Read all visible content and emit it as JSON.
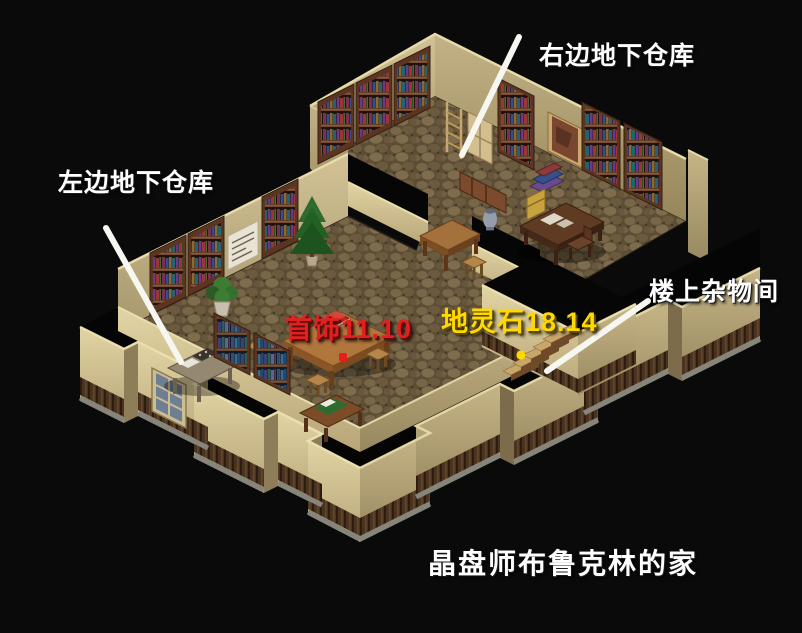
{
  "scene_title": "晶盘师布鲁克林的家",
  "annotations": {
    "right_basement": "右边地下仓库",
    "left_basement": "左边地下仓库",
    "upstairs_storage": "楼上杂物间",
    "jewelry_spot": "首饰11.10",
    "spirit_stone_spot": "地灵石18.14"
  },
  "markers": {
    "jewelry": {
      "shape": "square-dot",
      "color": "#ea1c1c"
    },
    "spirit_stone": {
      "shape": "round-dot",
      "color": "#ffd800"
    }
  },
  "colors": {
    "background": "#0a0a0a",
    "annotation_text": "#ffffff",
    "jewelry_text": "#e32020",
    "spirit_stone_text": "#ffd800",
    "pointer_line": "#f7f7f2",
    "wall_light": "#d8c795",
    "wall_shadow": "#9c8c62",
    "wainscot": "#4a331f",
    "floor": "#6a5a3e",
    "bookshelf_wood": "#5c3422"
  }
}
